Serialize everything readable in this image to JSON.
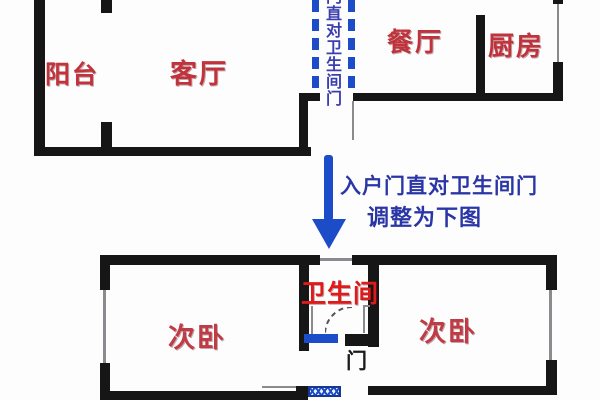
{
  "figure": "apartment-floor-plan-before-after",
  "colors": {
    "wall": "#161616",
    "background": "#fdfdfd",
    "red_label": "#c0333c",
    "red_bright": "#e01a1a",
    "red_dark": "#bf3b45",
    "blue": "#1d4cc9",
    "blue_text": "#2b36a6",
    "gray_line": "#8a8a8f"
  },
  "top_plan": {
    "balcony_label": "阳台",
    "living_label": "客厅",
    "dining_label": "餐厅",
    "kitchen_label": "厨房",
    "corridor_vertical_text": "门直对卫生间门"
  },
  "annotation": {
    "line1": "入户门直对卫生间门",
    "line2": "调整为下图"
  },
  "bottom_plan": {
    "bathroom_label": "卫生间",
    "bedroom_left_label": "次卧",
    "bedroom_right_label": "次卧",
    "door_label": "门"
  }
}
